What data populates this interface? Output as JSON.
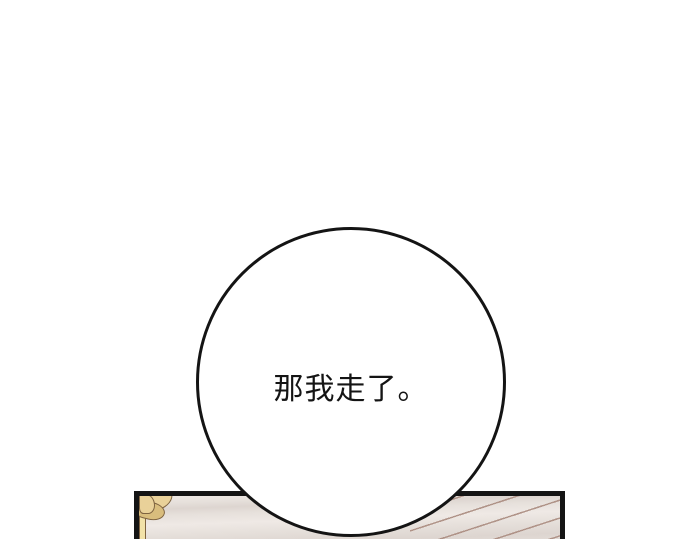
{
  "bubble": {
    "text": "那我走了。"
  },
  "colors": {
    "background": "#ffffff",
    "line_art": "#141414",
    "floor_base": "#e6e0db",
    "floor_streak_light": "#efe9e5",
    "floor_streak_dark": "#ddd5d0",
    "floorboard_line": "#aa8b7f",
    "gold_fill": "#e9d199",
    "gold_shade": "#d9bd7d",
    "gold_outline": "#7e6340",
    "gold_strip": "#f2e2a8"
  }
}
